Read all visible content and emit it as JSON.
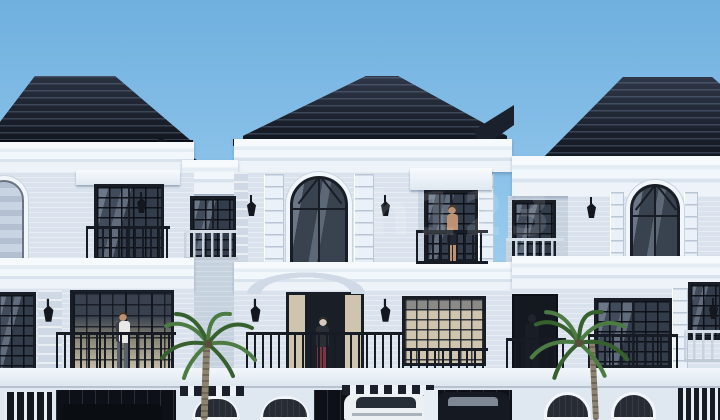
{
  "image": {
    "kind": "architectural-rendering",
    "description": "Front elevation rendering of a row of three-storey modern-classic townhouses with dark ridged hip roofs, white facades, black-framed windows, balconies, palm trees, people and cars in the garages under a clear blue sky.",
    "watermark": "h123"
  },
  "scene": {
    "houses": [
      {
        "label": "left-townhouse"
      },
      {
        "label": "middle-townhouse"
      },
      {
        "label": "right-townhouse"
      }
    ],
    "people": [
      {
        "label": "man-on-left-balcony",
        "detail": "man in white shirt and grey trousers on the first-floor balcony of the left house"
      },
      {
        "label": "woman-at-middle-door",
        "detail": "woman in dark top and maroon trousers at the middle house door"
      },
      {
        "label": "man-on-upper-balcony",
        "detail": "shirtless man in dark shorts on the upper balcony right of the middle house"
      },
      {
        "label": "person-in-right-doorway",
        "detail": "silhouetted person in the recessed doorway left of the right house"
      }
    ],
    "vehicles": [
      {
        "label": "white-suv",
        "detail": "white SUV parked in the middle garage"
      },
      {
        "label": "dark-suv",
        "detail": "dark SUV parked in the adjacent bay"
      },
      {
        "label": "car-in-left-garage",
        "detail": "dark car partially visible in the left garage"
      }
    ],
    "trees": [
      {
        "label": "palm-left"
      },
      {
        "label": "palm-right"
      }
    ]
  },
  "palette": {
    "sky_top": "#6fb0df",
    "sky_bottom": "#b6dbf2",
    "roof": "#161b25",
    "roof_ridge": "#323b4c",
    "roof_fascia": "#0a0e14",
    "cornice": "#f2f7fb",
    "wall": "#dae3ed",
    "wall_recess": "#c7d2df",
    "frame": "#181d26",
    "glass_dark": "#323c4b",
    "glass_tan": "#cfc5af",
    "glass_sky": "#c8d4e2",
    "railing_dark": "#171c24",
    "railing_light": "#d6dfe8",
    "garage": "#0d1016",
    "palm": "#4c7c44",
    "palm_dark": "#37602f",
    "trunk": "#837a68",
    "skin": "#bd9273",
    "maroon_pants": "#7d3542",
    "white_shirt": "#e9eae7",
    "grey_pants": "#596068",
    "car_white": "#edf0f3",
    "car_dark": "#151922"
  }
}
